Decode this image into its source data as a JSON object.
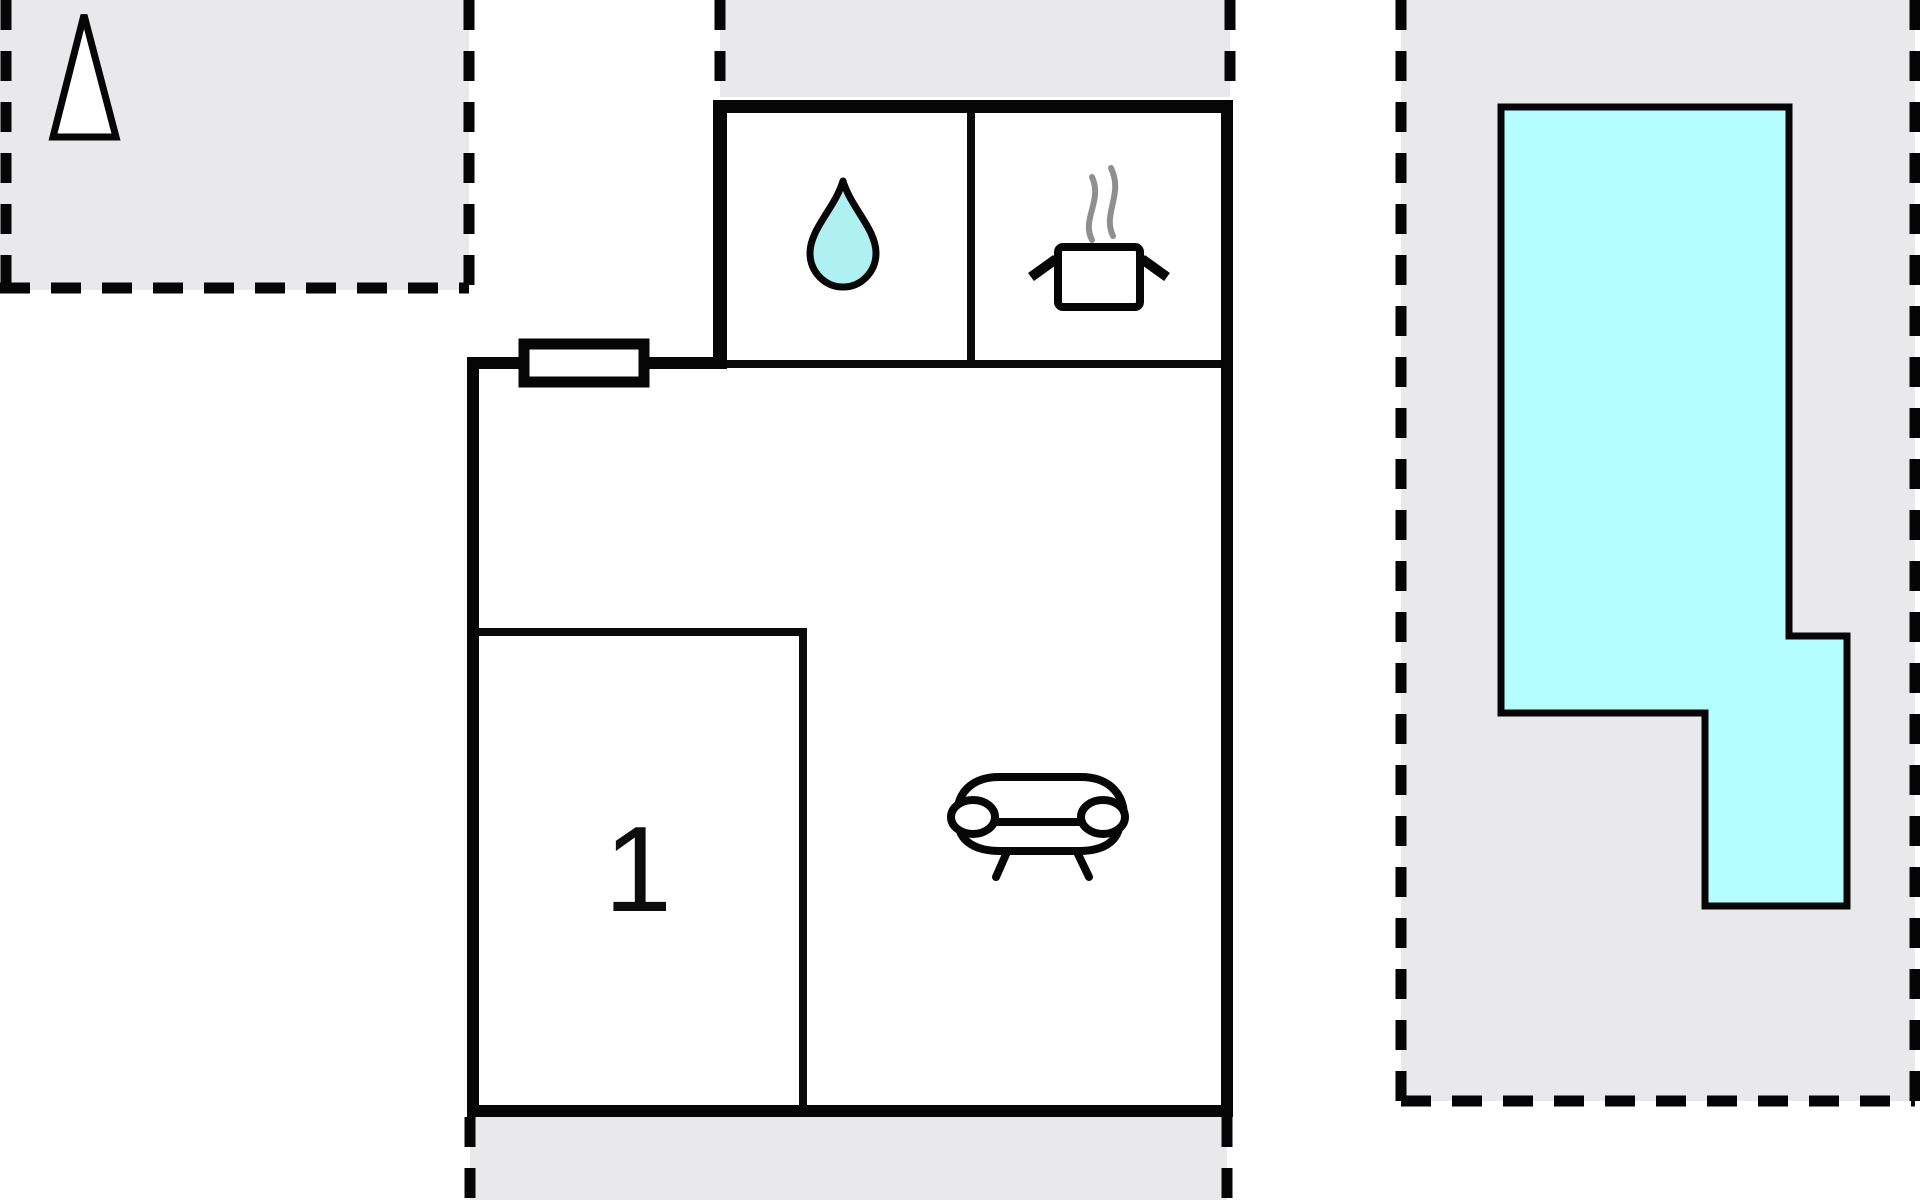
{
  "floorplan": {
    "room_label": "1",
    "colors": {
      "area_fill": "#e9e8eb",
      "wall": "#060606",
      "water_drop": "#aff0f2",
      "pool": "#b5feff",
      "steam": "#8f8f8f",
      "background": "#ffffff"
    },
    "icons": [
      {
        "name": "north-arrow-icon",
        "meaning": "orientation arrow"
      },
      {
        "name": "water-drop-icon",
        "meaning": "bathroom / water"
      },
      {
        "name": "cooking-pot-icon",
        "meaning": "kitchen"
      },
      {
        "name": "steam-icon",
        "meaning": "steam over pot"
      },
      {
        "name": "sofa-icon",
        "meaning": "living room seating"
      }
    ],
    "areas": [
      {
        "name": "terrace-top-left"
      },
      {
        "name": "terrace-top-strip"
      },
      {
        "name": "terrace-bottom"
      },
      {
        "name": "pool-area"
      },
      {
        "name": "pool"
      }
    ]
  }
}
